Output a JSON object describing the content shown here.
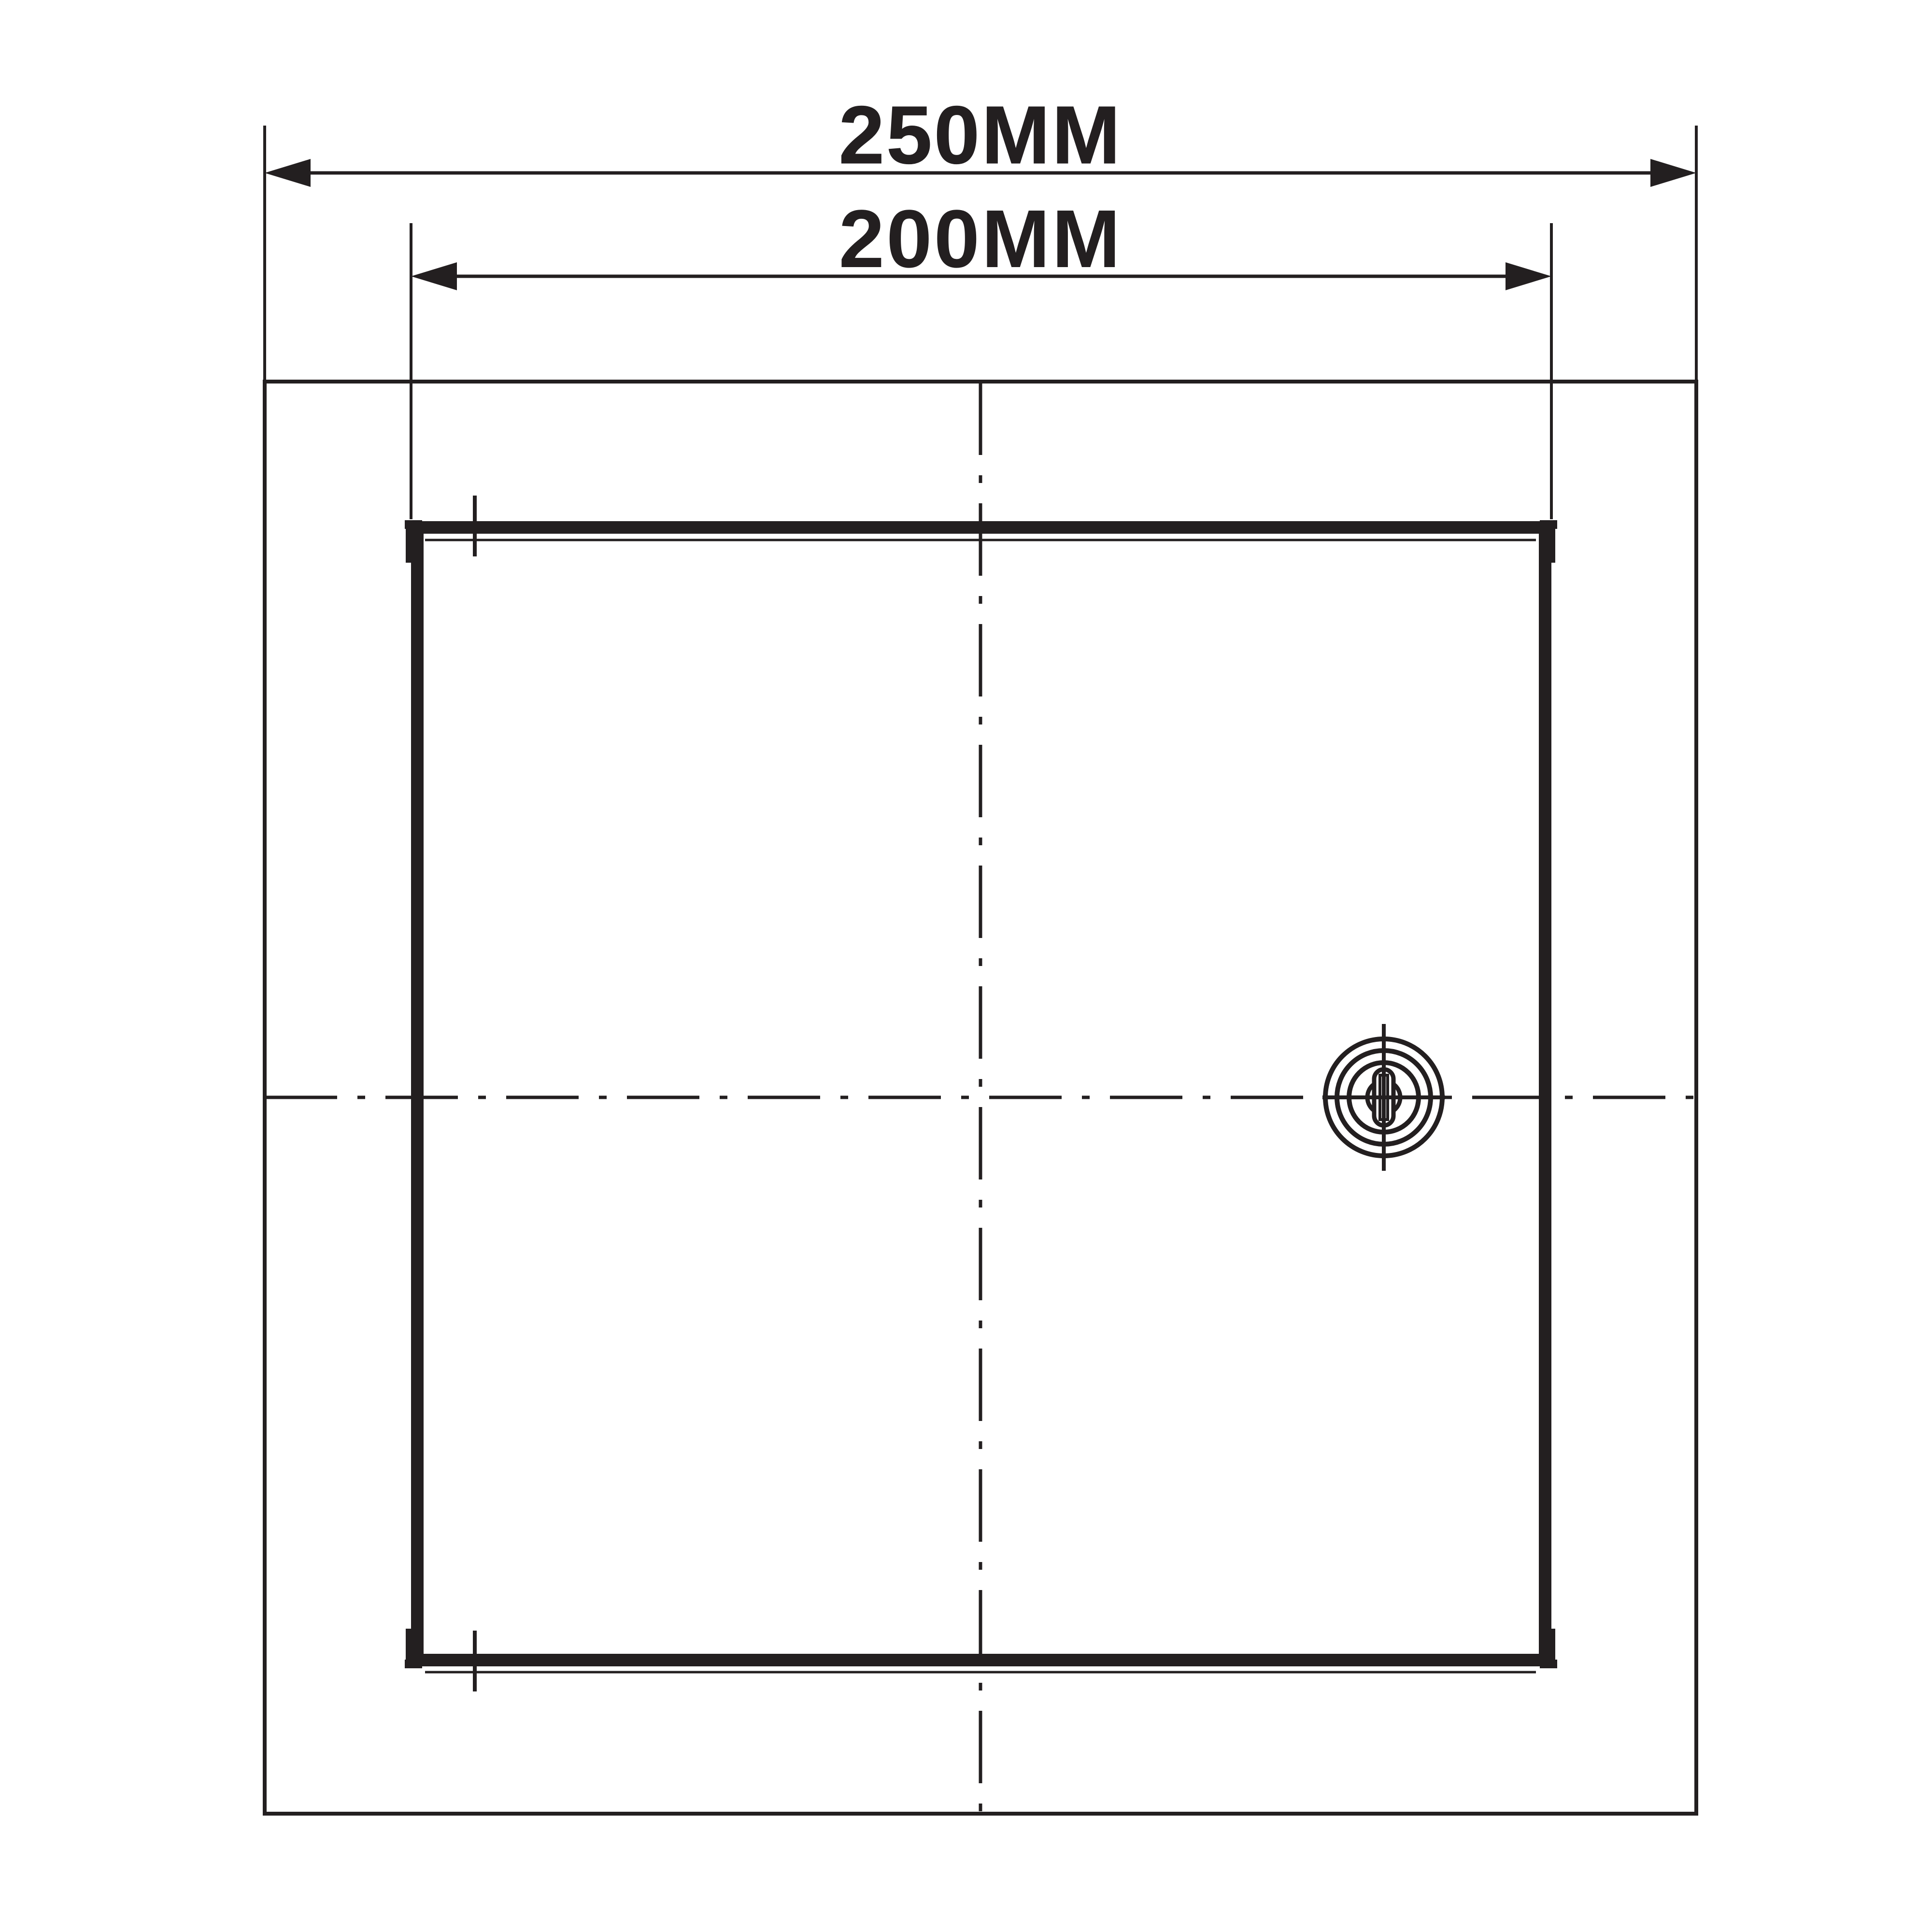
{
  "drawing": {
    "background": "#ffffff",
    "line_color": "#231f20",
    "labels": {
      "overall_width": "250MM",
      "panel_width": "200MM"
    }
  }
}
